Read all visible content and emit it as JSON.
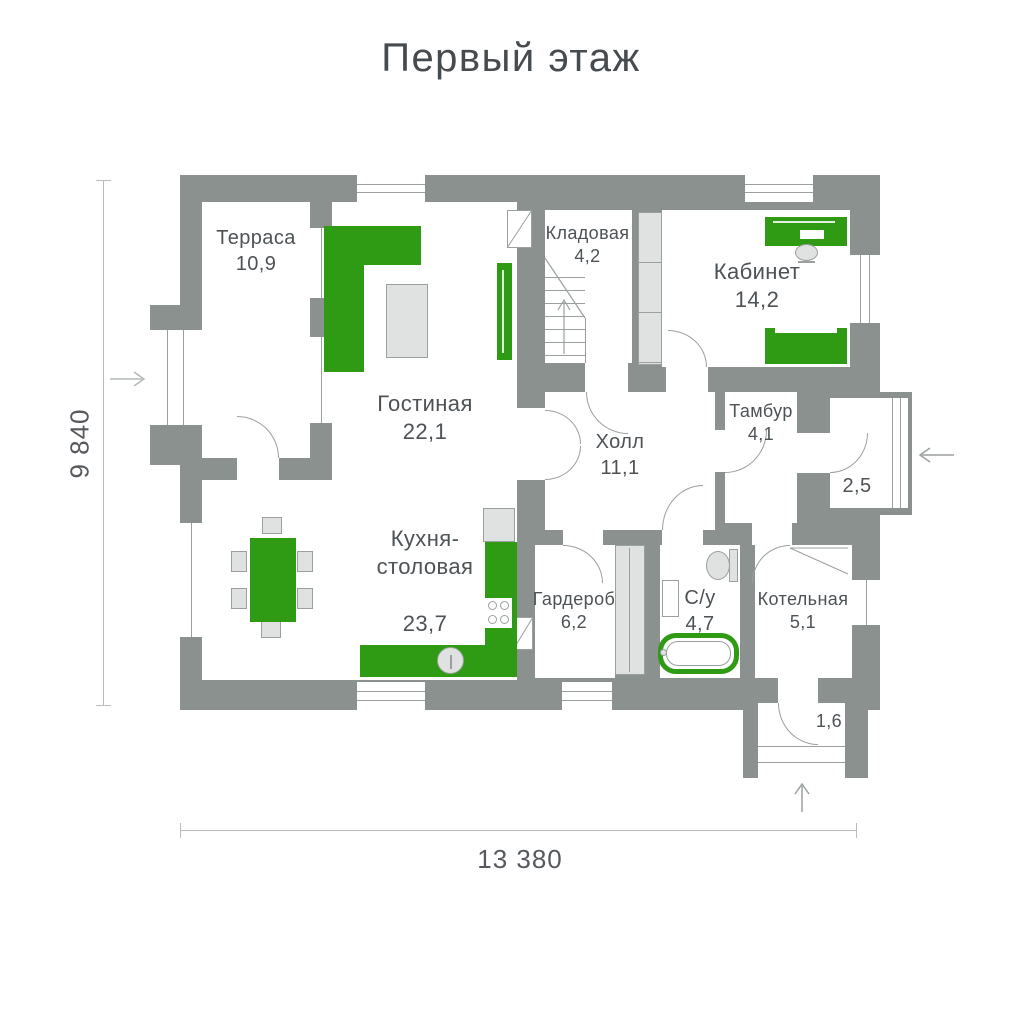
{
  "title": "Первый этаж",
  "dimensions": {
    "height_label": "9 840",
    "width_label": "13 380"
  },
  "rooms": [
    {
      "name": "Терраса",
      "area": "10,9"
    },
    {
      "name": "Гостиная",
      "area": "22,1"
    },
    {
      "name": "Кладовая",
      "area": "4,2"
    },
    {
      "name": "Кабинет",
      "area": "14,2"
    },
    {
      "name": "Холл",
      "area": "11,1"
    },
    {
      "name": "Тамбур",
      "area": "4,1"
    },
    {
      "name": "",
      "area": "2,5"
    },
    {
      "name": "Кухня-\nстоловая",
      "area": "23,7"
    },
    {
      "name": "Гардероб",
      "area": "6,2"
    },
    {
      "name": "С/у",
      "area": "4,7"
    },
    {
      "name": "Котельная",
      "area": "5,1"
    },
    {
      "name": "",
      "area": "1,6"
    }
  ],
  "colors": {
    "wall": "#8b918e",
    "accent_green": "#2f9b15",
    "furniture_gray": "#e0e2e1",
    "line": "#9aa09d",
    "text": "#4c5256"
  }
}
